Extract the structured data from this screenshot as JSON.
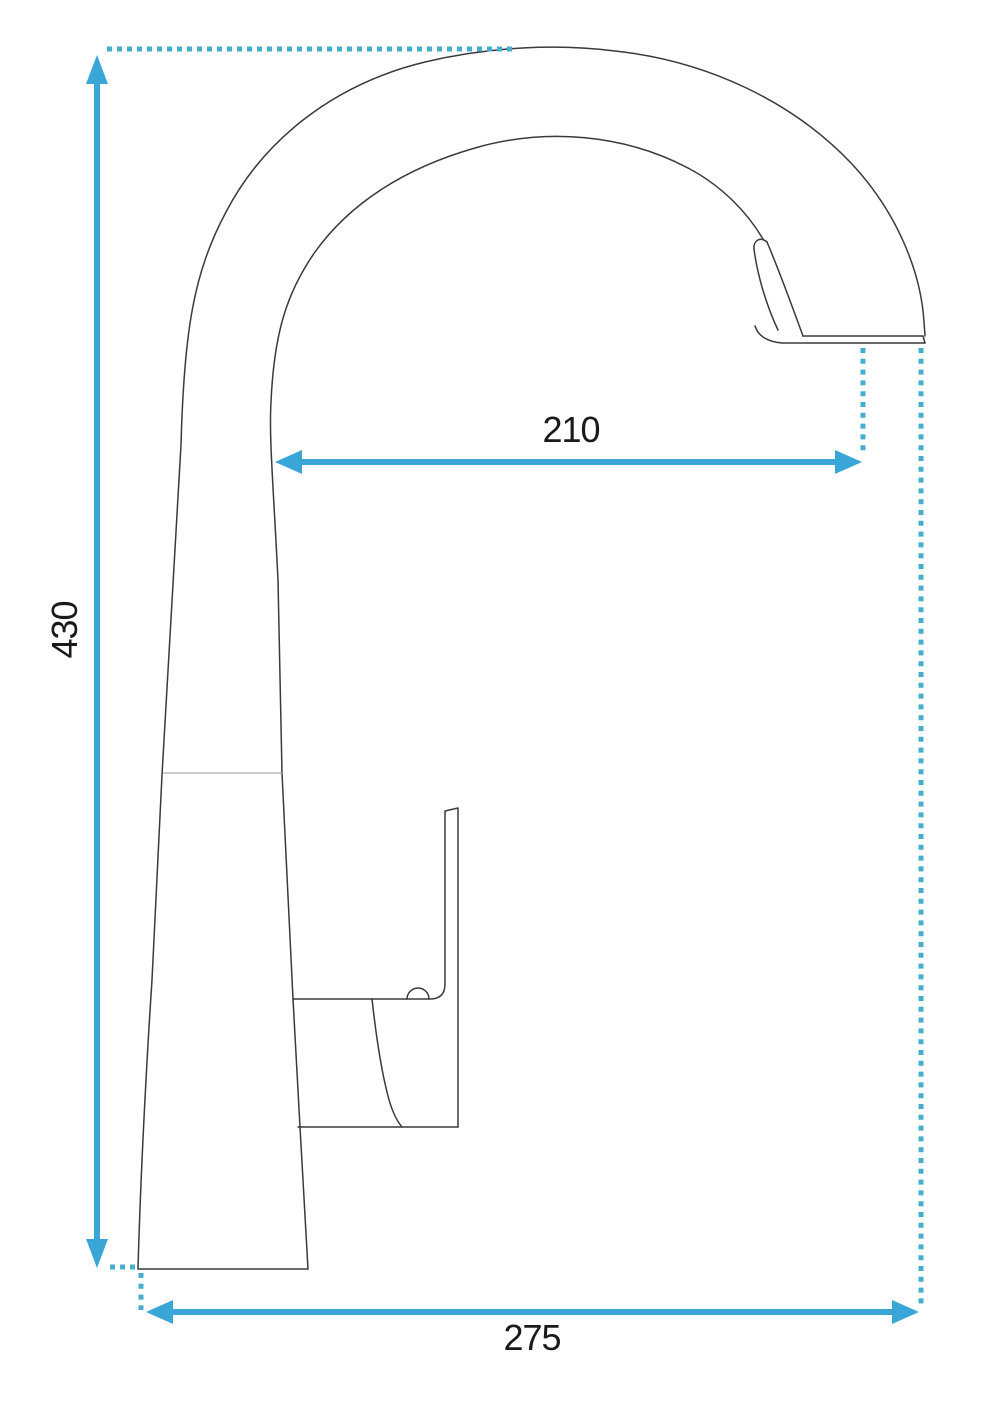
{
  "diagram": {
    "type": "technical-drawing",
    "subject": "kitchen-faucet-side-view",
    "dimensions": {
      "height": {
        "value": "430",
        "axis": "vertical",
        "unit": "mm"
      },
      "spout_reach": {
        "value": "210",
        "axis": "horizontal",
        "unit": "mm"
      },
      "overall_depth": {
        "value": "275",
        "axis": "horizontal",
        "unit": "mm"
      }
    },
    "colors": {
      "accent": "#3aa6d8",
      "dots": "#47adcf",
      "outline": "#3a3a3a",
      "outline_light": "#9a9a9a",
      "label": "#1a1a1a",
      "background": "#ffffff"
    }
  }
}
